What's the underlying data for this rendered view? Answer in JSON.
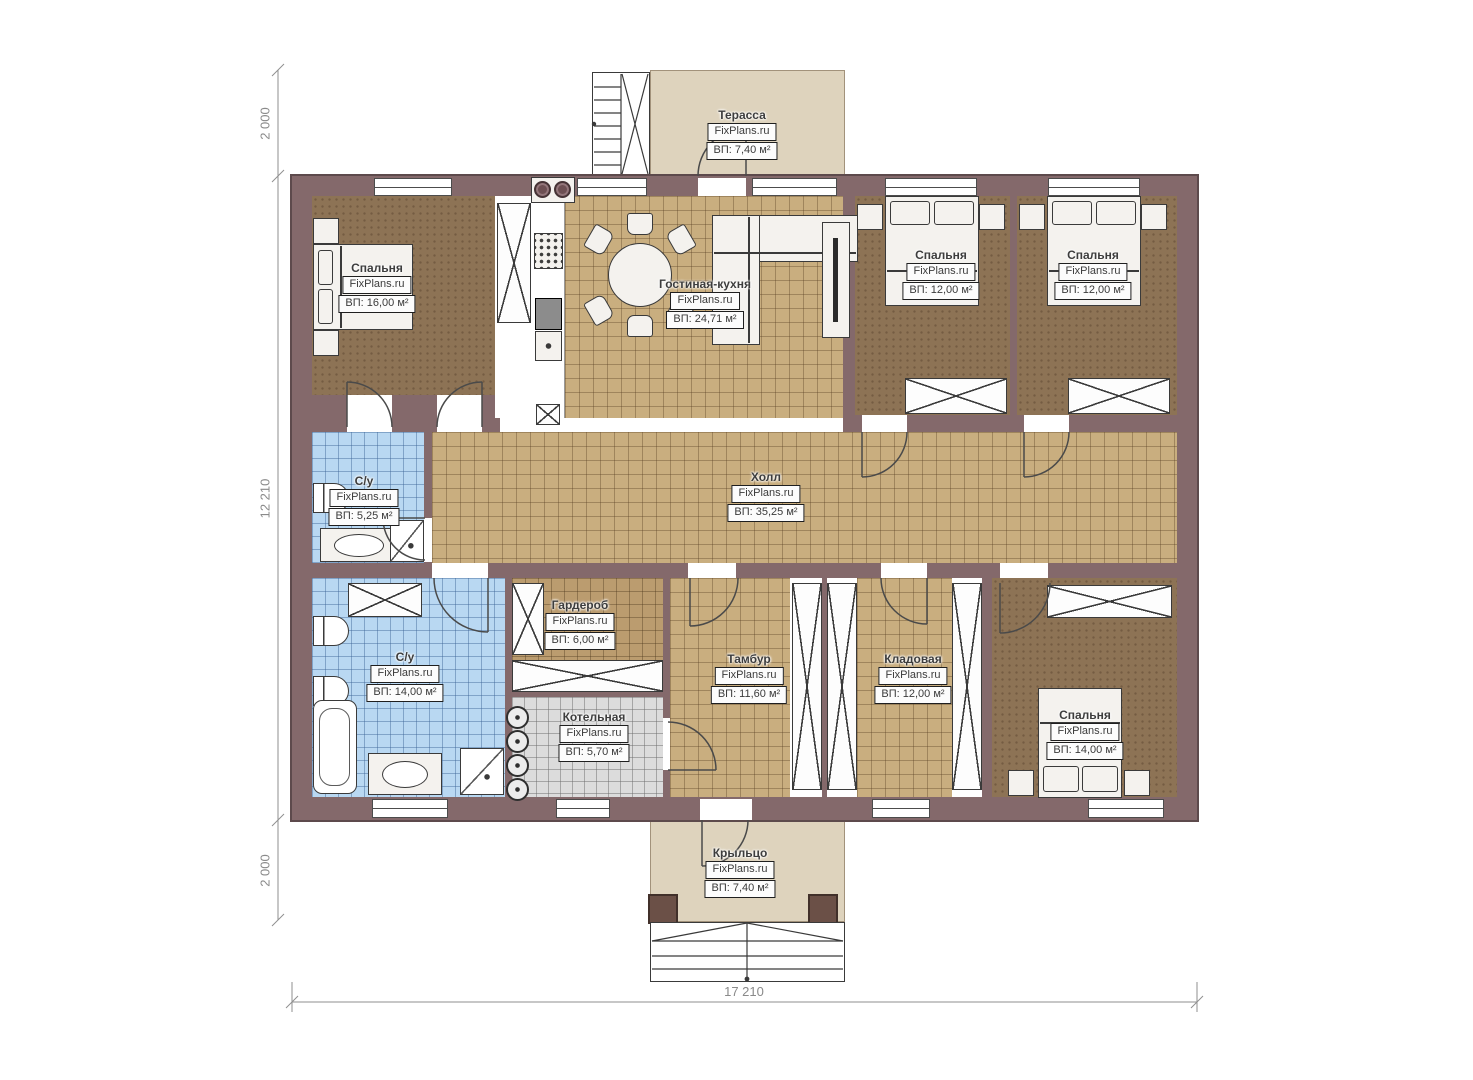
{
  "plan": {
    "watermark": "FixPlans.ru",
    "rooms": [
      {
        "name": "Терасса",
        "brand": "FixPlans.ru",
        "area": "ВП: 7,40 м²"
      },
      {
        "name": "Спальня",
        "brand": "FixPlans.ru",
        "area": "ВП: 16,00 м²"
      },
      {
        "name": "Гостиная-кухня",
        "brand": "FixPlans.ru",
        "area": "ВП: 24,71 м²"
      },
      {
        "name": "Спальня",
        "brand": "FixPlans.ru",
        "area": "ВП: 12,00 м²"
      },
      {
        "name": "Спальня",
        "brand": "FixPlans.ru",
        "area": "ВП: 12,00 м²"
      },
      {
        "name": "С/у",
        "brand": "FixPlans.ru",
        "area": "ВП: 5,25 м²"
      },
      {
        "name": "Холл",
        "brand": "FixPlans.ru",
        "area": "ВП: 35,25 м²"
      },
      {
        "name": "С/у",
        "brand": "FixPlans.ru",
        "area": "ВП: 14,00 м²"
      },
      {
        "name": "Гардероб",
        "brand": "FixPlans.ru",
        "area": "ВП: 6,00 м²"
      },
      {
        "name": "Котельная",
        "brand": "FixPlans.ru",
        "area": "ВП: 5,70 м²"
      },
      {
        "name": "Тамбур",
        "brand": "FixPlans.ru",
        "area": "ВП: 11,60 м²"
      },
      {
        "name": "Кладовая",
        "brand": "FixPlans.ru",
        "area": "ВП: 12,00 м²"
      },
      {
        "name": "Спальня",
        "brand": "FixPlans.ru",
        "area": "ВП: 14,00 м²"
      },
      {
        "name": "Крыльцо",
        "brand": "FixPlans.ru",
        "area": "ВП: 7,40 м²"
      }
    ],
    "dimensions": {
      "left_top": "2 000",
      "left_middle": "12 210",
      "left_bottom": "2 000",
      "bottom_width": "17 210"
    },
    "palette": {
      "wall": "#84696b",
      "tile_tan": "#c9ae7f",
      "tile_blue": "#b9d8f2",
      "tile_gray": "#dcdcdc",
      "floor_brown": "#8d7355",
      "deck_beige": "#ded3bd"
    }
  }
}
